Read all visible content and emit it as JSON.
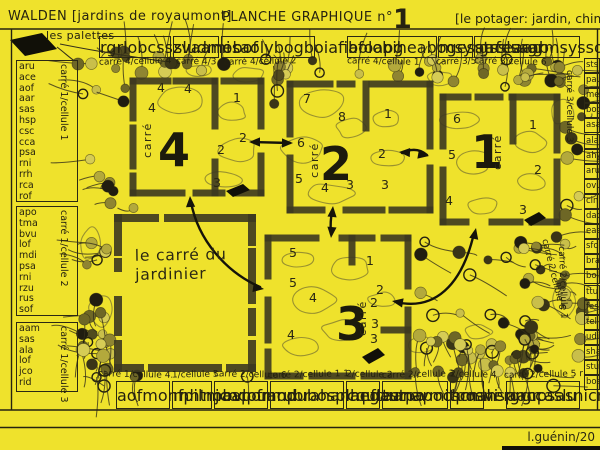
{
  "header": {
    "title_left": "WALDEN [jardins de royaumont]",
    "title_center": "PLANCHE GRAPHIQUE n°",
    "title_center_number": "1",
    "title_right": "[le potager: jardin, chimères]"
  },
  "legend": {
    "palettes_label": "les palettes"
  },
  "signature": "l.guénin/20",
  "jardinier": {
    "line1": "le carré du",
    "line2": "jardinier"
  },
  "colors": {
    "background": "#EFE22C",
    "ink": "#262310",
    "frame": "#3d3920",
    "contour": "#8a8230",
    "arrow": "#15130a",
    "dot_palette": [
      "#514b1e",
      "#6e6726",
      "#8f8531",
      "#b3a93c",
      "#c9bf4a",
      "#201d10",
      "#3a3517",
      "#d6cc55"
    ]
  },
  "squares": [
    {
      "id": "carre-4",
      "word": "carré",
      "numeral": "4",
      "cells": [
        "4",
        "4",
        "4",
        "1",
        "2",
        "2",
        "3"
      ]
    },
    {
      "id": "carre-2",
      "word": "carré",
      "numeral": "2",
      "cells": [
        "7",
        "8",
        "1",
        "6",
        "2",
        "5",
        "4",
        "3",
        "3"
      ]
    },
    {
      "id": "carre-1",
      "word": "carré",
      "numeral": "1",
      "cells": [
        "6",
        "1",
        "5",
        "2",
        "4",
        "3"
      ]
    },
    {
      "id": "carre-3",
      "word": "carré",
      "numeral": "3",
      "cells": [
        "5",
        "1",
        "5",
        "4",
        "2",
        "2",
        "3",
        "3",
        "4"
      ]
    }
  ],
  "borders": {
    "left_groups": [
      {
        "caption": "carré 1/cellule 1",
        "codes": [
          "aru",
          "ace",
          "aof",
          "aar",
          "sas",
          "hsp",
          "csc",
          "cca",
          "psa",
          "rni",
          "rrh",
          "rca",
          "rof"
        ]
      },
      {
        "caption": "carré 1/cellule 2",
        "codes": [
          "apo",
          "tma",
          "bvu",
          "lof",
          "mdi",
          "psa",
          "rni",
          "rzu",
          "rus",
          "sof"
        ]
      },
      {
        "caption": "carré 1/cellule 3",
        "codes": [
          "aam",
          "sas",
          "ala",
          "lof",
          "jco",
          "rid"
        ]
      }
    ],
    "top_groups": [
      {
        "caption": "carré 4/cellule 4",
        "codes": [
          "rgr",
          "lob",
          "css",
          "zva",
          "ami"
        ]
      },
      {
        "caption": "carré 4/3",
        "codes": [
          "slu",
          "dmo",
          "bof"
        ]
      },
      {
        "caption": "carré 4/cellule 2",
        "codes": [
          "esa",
          "oly",
          "bog",
          "boi",
          "afi",
          "afo",
          "apg"
        ]
      },
      {
        "caption": "carré 4/cellule 1",
        "codes": [
          "bol",
          "obi",
          "hea",
          "bog",
          "esa",
          "ace",
          "aag"
        ]
      },
      {
        "caption": "carré 3/5",
        "codes": [
          "msy",
          "rgr",
          "fes",
          "aab"
        ]
      },
      {
        "caption": "carré 3/cellule 6",
        "codes": [
          "sts",
          "slu",
          "rgr",
          "msy",
          "sso",
          "phf",
          "pfr",
          "ovu",
          "cin",
          "apo"
        ]
      }
    ],
    "bottom_groups": [
      {
        "caption": "carré 1/cellule 4.",
        "codes": [
          "aof",
          "mon",
          "fpi",
          "lno",
          "bvl",
          "pfr"
        ]
      },
      {
        "caption": "1/cellule 5.",
        "codes": [
          "rnh",
          "tma",
          "apo",
          "mod"
        ]
      },
      {
        "caption": "carré 2/cellule 6",
        "codes": [
          "jco",
          "cou",
          "aru",
          "bra",
          "han",
          "hnf",
          "ttu"
        ]
      },
      {
        "caption": "carré 2/cellule 1 1",
        "codes": [
          "mpu",
          "bos",
          "pla",
          "ega",
          "une",
          "vmi",
          "tpo",
          "sni"
        ]
      },
      {
        "caption": "2/cellule 2",
        "codes": [
          "cqu",
          "les",
          "tpo"
        ]
      },
      {
        "caption": "carré 2/cellule 3",
        "codes": [
          "aan",
          "apo",
          "csc",
          "mve",
          "rgr",
          "cca",
          "slu"
        ]
      },
      {
        "caption": "2/cellule 4",
        "codes": [
          "hma",
          "hsp",
          "rgr"
        ]
      },
      {
        "caption": "carré 2/cellule 5 r",
        "codes": [
          "aan",
          "psa",
          "sni",
          "cnu",
          "rus",
          "stu"
        ]
      }
    ],
    "right": {
      "captions": [
        "carré 3/cellule 3",
        "carré 2/cellule 6",
        "carré 2/cellule 1"
      ],
      "codes": [
        "sts",
        "pau",
        "mel",
        "bog",
        "asa",
        "ala",
        "ahy",
        "aru",
        "ovu",
        "cin",
        "dad",
        "eae",
        "sfo",
        "bra",
        "bol",
        "ttu",
        "fes",
        "tel",
        "udi",
        "sha",
        "stu",
        "bos"
      ]
    }
  }
}
